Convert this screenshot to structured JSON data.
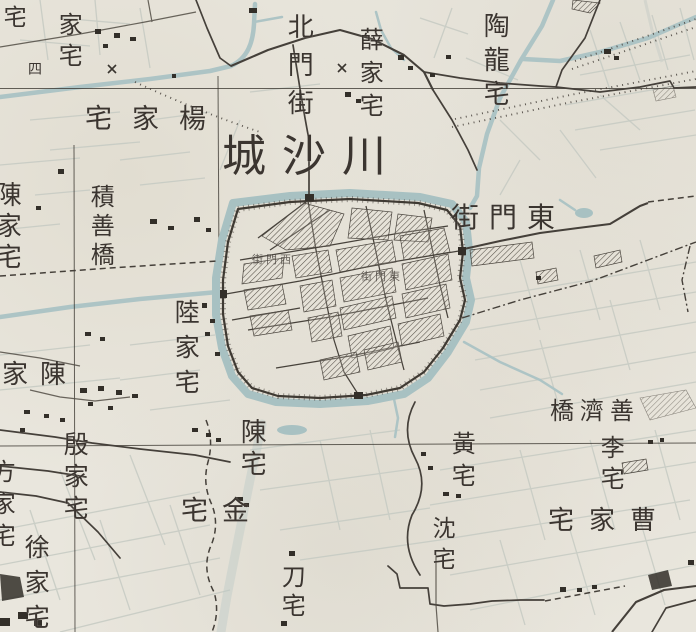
{
  "map": {
    "title": "川沙城",
    "reading_direction_note": "labels written right-to-left / top-to-bottom",
    "colors": {
      "paper": "#e9e6dd",
      "water": "#adc4c5",
      "ink": "#45403a",
      "hatch": "#565048",
      "field_line": "#c7cbc3"
    },
    "labels": [
      {
        "id": "chuansha-city-title",
        "text": "川沙城",
        "orient": "h-rtl",
        "x": 222,
        "y": 134,
        "size": 44,
        "spacing": 16
      },
      {
        "id": "north-gate-street",
        "text": "北門街",
        "orient": "v",
        "x": 284,
        "y": 13,
        "size": 26,
        "spacing": 12
      },
      {
        "id": "xue-jia-zhai",
        "text": "薛家宅",
        "orient": "v",
        "x": 356,
        "y": 27,
        "size": 24,
        "spacing": 9
      },
      {
        "id": "tao-long-zhai",
        "text": "陶龍宅",
        "orient": "v",
        "x": 480,
        "y": 12,
        "size": 26,
        "spacing": 8
      },
      {
        "id": "jia-zhai-partial",
        "text": "家宅",
        "orient": "v",
        "x": 55,
        "y": 12,
        "size": 24,
        "spacing": 7
      },
      {
        "id": "zhai-single-topleft",
        "text": "宅",
        "orient": "v",
        "x": 0,
        "y": 5,
        "size": 23,
        "spacing": 0
      },
      {
        "id": "grid-label-four",
        "text": "四",
        "orient": "h",
        "x": 28,
        "y": 63,
        "size": 14,
        "spacing": 0
      },
      {
        "id": "yang-jia-zhai",
        "text": "楊家宅",
        "orient": "h-rtl",
        "x": 85,
        "y": 106,
        "size": 27,
        "spacing": 20
      },
      {
        "id": "chen-jia-zhai-west",
        "text": "陳家宅",
        "orient": "v",
        "x": -8,
        "y": 181,
        "size": 26,
        "spacing": 5
      },
      {
        "id": "jishan-bridge",
        "text": "積善橋",
        "orient": "v",
        "x": 87,
        "y": 184,
        "size": 24,
        "spacing": 5
      },
      {
        "id": "east-gate-street",
        "text": "東門街",
        "orient": "h-rtl",
        "x": 451,
        "y": 203,
        "size": 28,
        "spacing": 10
      },
      {
        "id": "lu-jia-zhai",
        "text": "陸家宅",
        "orient": "v",
        "x": 172,
        "y": 299,
        "size": 25,
        "spacing": 10
      },
      {
        "id": "chen-jia-zhai-southwest",
        "text": "陳家宅",
        "orient": "h-rtl",
        "x": -36,
        "y": 362,
        "size": 26,
        "spacing": 12
      },
      {
        "id": "yin-jia-zhai",
        "text": "殷家宅",
        "orient": "v",
        "x": 61,
        "y": 431,
        "size": 25,
        "spacing": 7
      },
      {
        "id": "fang-jia-zhai-partial",
        "text": "方家宅",
        "orient": "v",
        "x": -12,
        "y": 459,
        "size": 24,
        "spacing": 8
      },
      {
        "id": "xu-jia-zhai",
        "text": "徐家宅",
        "orient": "v",
        "x": 22,
        "y": 534,
        "size": 25,
        "spacing": 10
      },
      {
        "id": "chen-zhai",
        "text": "陳宅",
        "orient": "v",
        "x": 237,
        "y": 418,
        "size": 26,
        "spacing": 6
      },
      {
        "id": "jin-zhai",
        "text": "金宅",
        "orient": "h-rtl",
        "x": 181,
        "y": 498,
        "size": 27,
        "spacing": 14
      },
      {
        "id": "dao-zhai",
        "text": "刀宅",
        "orient": "v",
        "x": 278,
        "y": 564,
        "size": 24,
        "spacing": 5
      },
      {
        "id": "huang-zhai",
        "text": "黃宅",
        "orient": "v",
        "x": 448,
        "y": 431,
        "size": 24,
        "spacing": 8
      },
      {
        "id": "shen-zhai",
        "text": "沈宅",
        "orient": "v",
        "x": 429,
        "y": 516,
        "size": 23,
        "spacing": 8
      },
      {
        "id": "shanji-bridge",
        "text": "善濟橋",
        "orient": "h-rtl",
        "x": 550,
        "y": 399,
        "size": 24,
        "spacing": 6
      },
      {
        "id": "li-zhai",
        "text": "李宅",
        "orient": "v",
        "x": 597,
        "y": 435,
        "size": 24,
        "spacing": 7
      },
      {
        "id": "cao-jia-zhai",
        "text": "曹家宅",
        "orient": "h-rtl",
        "x": 548,
        "y": 508,
        "size": 26,
        "spacing": 15
      },
      {
        "id": "west-gate-street-small",
        "text": "西門街",
        "orient": "h-rtl",
        "x": 252,
        "y": 254,
        "size": 11,
        "spacing": 3,
        "opacity": 0.75
      },
      {
        "id": "east-gate-street-small",
        "text": "東門街",
        "orient": "h-rtl",
        "x": 361,
        "y": 271,
        "size": 11,
        "spacing": 3,
        "opacity": 0.75
      }
    ]
  }
}
